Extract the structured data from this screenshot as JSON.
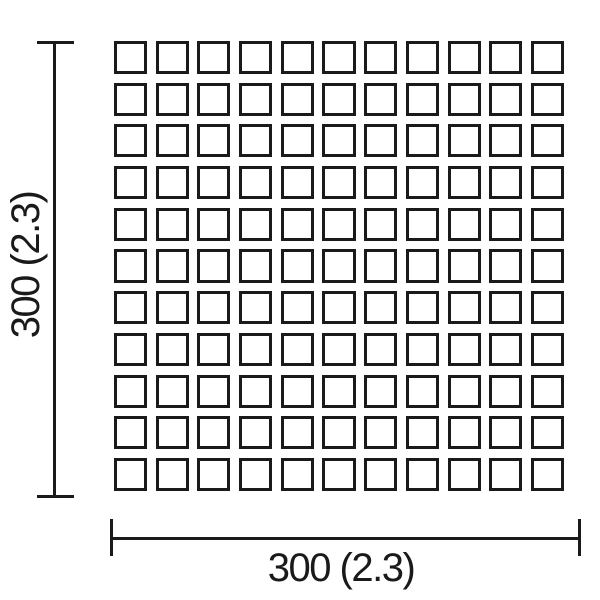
{
  "diagram": {
    "type": "tile-sheet-dimension-drawing",
    "grid": {
      "rows": 11,
      "cols": 11,
      "cell_shape": "square"
    },
    "dimensions": {
      "width_label": "300 (2.3)",
      "height_label": "300 (2.3)"
    },
    "colors": {
      "line": "#1a1a1a",
      "background": "#ffffff"
    }
  }
}
